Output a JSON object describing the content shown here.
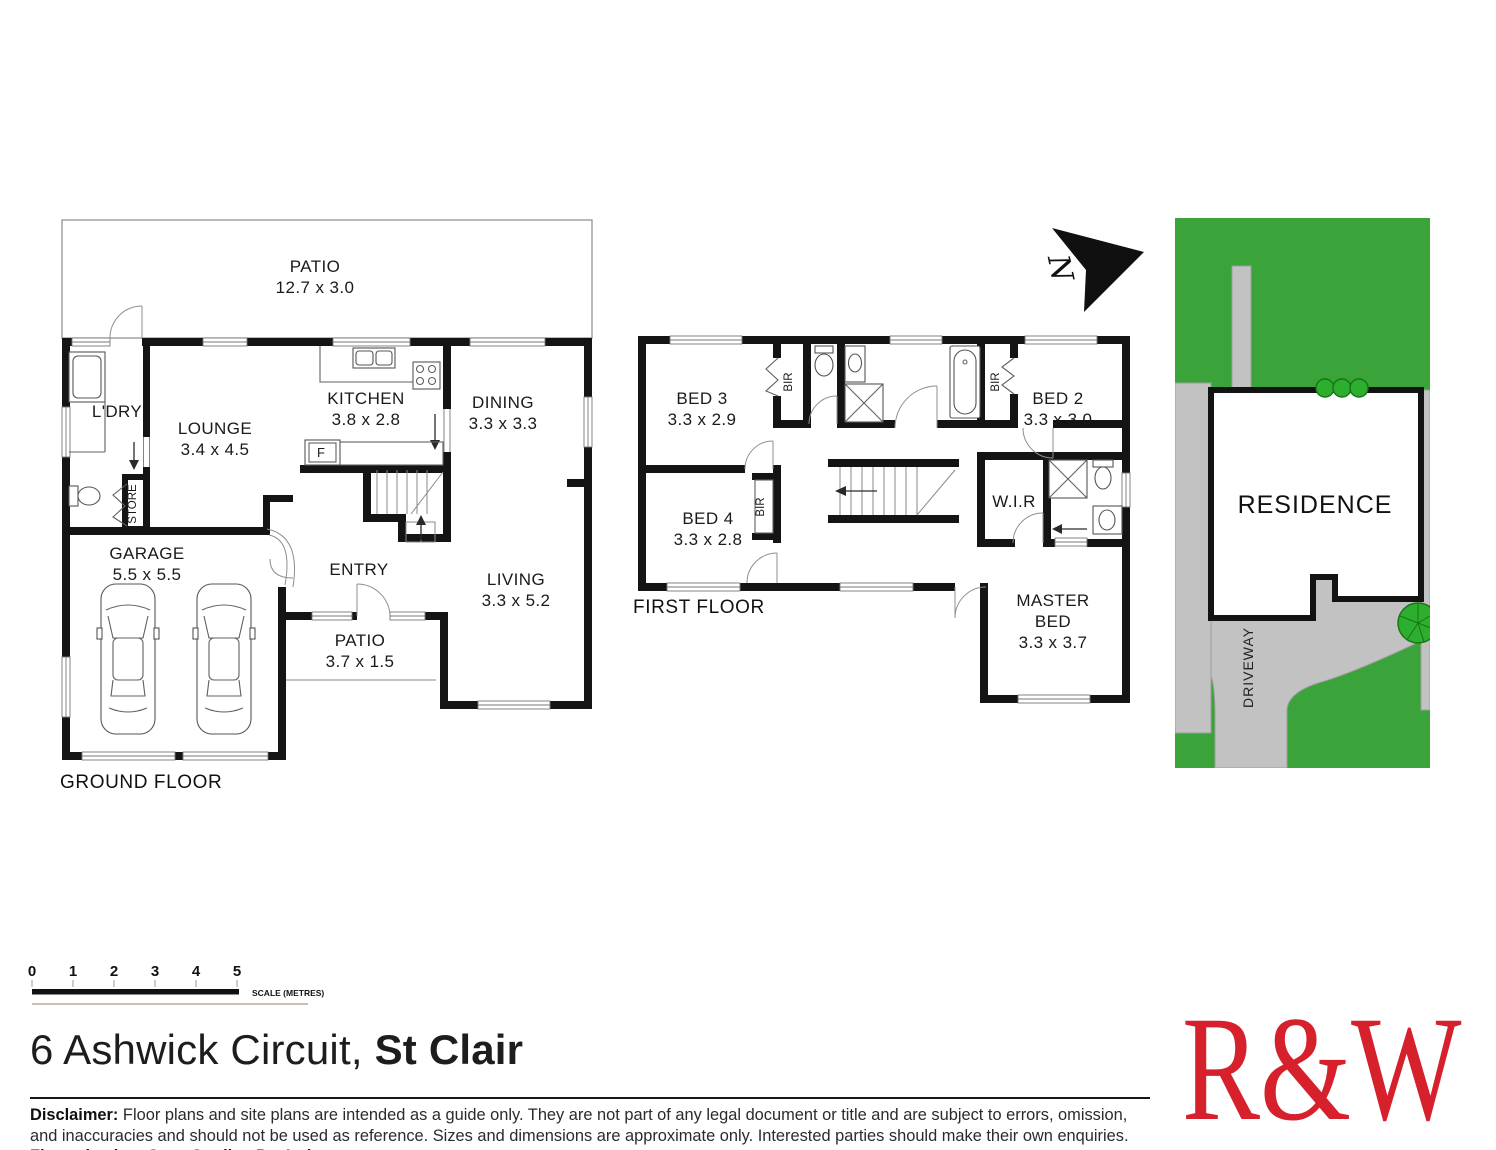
{
  "ground_floor": {
    "floor_label": "GROUND FLOOR",
    "patio_top": {
      "name": "PATIO",
      "dims": "12.7 x 3.0"
    },
    "ldry": {
      "name": "L'DRY"
    },
    "store": {
      "name": "STORE"
    },
    "lounge": {
      "name": "LOUNGE",
      "dims": "3.4 x 4.5"
    },
    "kitchen": {
      "name": "KITCHEN",
      "dims": "3.8 x 2.8"
    },
    "dining": {
      "name": "DINING",
      "dims": "3.3 x 3.3"
    },
    "fridge": {
      "name": "F"
    },
    "garage": {
      "name": "GARAGE",
      "dims": "5.5 x 5.5"
    },
    "entry": {
      "name": "ENTRY"
    },
    "patio_front": {
      "name": "PATIO",
      "dims": "3.7 x 1.5"
    },
    "living": {
      "name": "LIVING",
      "dims": "3.3 x 5.2"
    }
  },
  "first_floor": {
    "floor_label": "FIRST FLOOR",
    "bed3": {
      "name": "BED 3",
      "dims": "3.3 x 2.9"
    },
    "bed4": {
      "name": "BED 4",
      "dims": "3.3 x 2.8"
    },
    "bed2": {
      "name": "BED 2",
      "dims": "3.3 x 3.0"
    },
    "master": {
      "line1": "MASTER",
      "line2": "BED",
      "dims": "3.3 x 3.7"
    },
    "wir": {
      "name": "W.I.R"
    },
    "bir": "BIR"
  },
  "site_plan": {
    "residence_label": "RESIDENCE",
    "driveway_label": "DRIVEWAY"
  },
  "north": {
    "label": "N"
  },
  "scale_bar": {
    "ticks": [
      "0",
      "1",
      "2",
      "3",
      "4",
      "5"
    ],
    "caption": "SCALE (METRES)"
  },
  "title": {
    "address": "6 Ashwick Circuit,",
    "suburb": "St Clair"
  },
  "disclaimer": {
    "label": "Disclaimer:",
    "body": " Floor plans and site plans are intended as a guide only. They are not part of any legal document or title and are subject to errors, omission, and inaccuracies and should not be used as reference. Sizes and dimensions are approximate only. Interested parties should make their own enquiries. ",
    "credit": "Floor plan by : Sync Studios Pty Ltd"
  },
  "logo": {
    "text": "R&W"
  },
  "colors": {
    "logo_red": "#d6202c",
    "grass_green": "#3aa33a",
    "paving_gray": "#c2c2c2",
    "tree_green": "#2eae2e",
    "wall_black": "#141414"
  }
}
